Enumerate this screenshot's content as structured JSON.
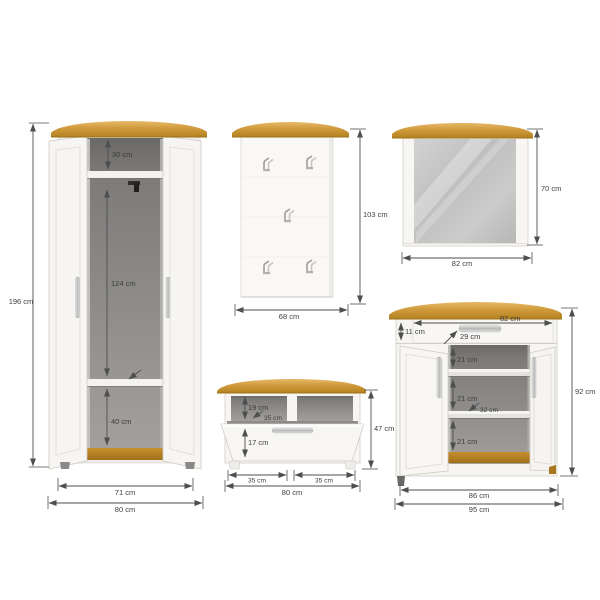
{
  "unit": "cm",
  "wardrobe": {
    "height": "196 cm",
    "top_compartment_height": "30 cm",
    "middle_compartment_height": "124 cm",
    "bottom_compartment_height": "40 cm",
    "inner_width": "71 cm",
    "width": "80 cm"
  },
  "panel": {
    "height": "103 cm",
    "width": "68 cm"
  },
  "mirror": {
    "height": "70 cm",
    "width": "82 cm"
  },
  "bench": {
    "height": "47 cm",
    "compartment_height": "19 cm",
    "compartment_depth": "35 cm",
    "drawer_height": "17 cm",
    "left_compartment_width": "35 cm",
    "right_compartment_width": "35 cm",
    "width": "80 cm"
  },
  "sideboard": {
    "height": "92 cm",
    "drawer_width": "82 cm",
    "drawer_height": "11 cm",
    "drawer_depth": "29 cm",
    "compartment1_height": "21 cm",
    "compartment2_height": "21 cm",
    "shelf_depth": "32 cm",
    "compartment3_height": "21 cm",
    "inner_width": "86 cm",
    "width": "95 cm"
  },
  "colors": {
    "wood_top": "#cf9a3c",
    "body_white": "#f6f5f2",
    "interior_grey": "#8f8d8b",
    "mirror_glass": "#c4c4c4",
    "metal_handle": "#c2c2c2",
    "dimension_line": "#4e4e4e",
    "label_text": "#3d3d3d"
  }
}
